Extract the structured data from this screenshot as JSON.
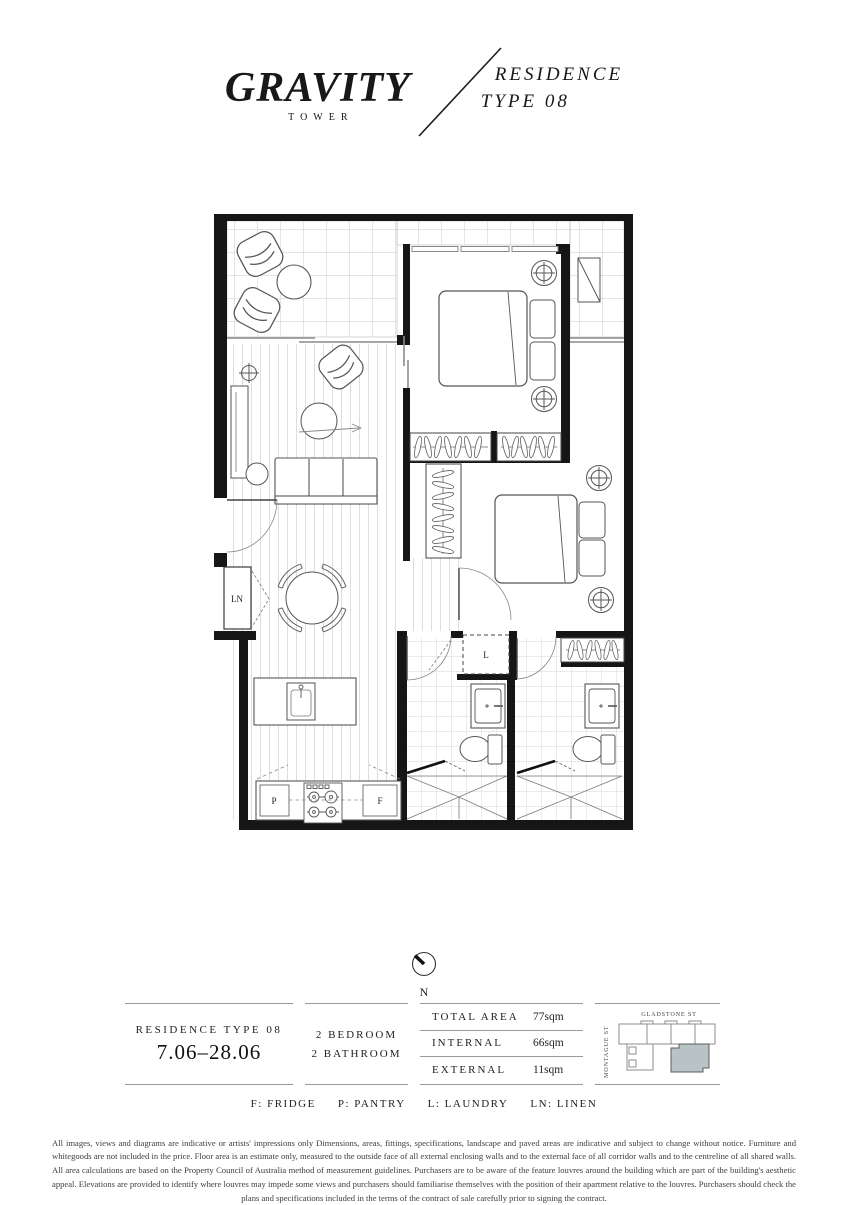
{
  "header": {
    "brand": "GRAVITY",
    "brand_sub": "TOWER",
    "residence_line1": "RESIDENCE",
    "residence_line2": "TYPE 08"
  },
  "plan": {
    "labels": {
      "linen": "LN",
      "laundry": "L",
      "pantry": "P",
      "fridge": "F"
    }
  },
  "compass": {
    "north_label": "N"
  },
  "info": {
    "residence_title": "RESIDENCE TYPE 08",
    "residence_levels": "7.06–28.06",
    "config_line1": "2 BEDROOM",
    "config_line2": "2 BATHROOM",
    "areas": {
      "rows": [
        {
          "label": "TOTAL AREA",
          "value": "77sqm"
        },
        {
          "label": "INTERNAL",
          "value": "66sqm"
        },
        {
          "label": "EXTERNAL",
          "value": "11sqm"
        }
      ]
    },
    "keyplan": {
      "street_top": "GLADSTONE ST",
      "street_left": "MONTAGUE ST",
      "highlight_color": "#b7c3c4"
    }
  },
  "legend": {
    "items": [
      "F: FRIDGE",
      "P: PANTRY",
      "L: LAUNDRY",
      "LN: LINEN"
    ]
  },
  "disclaimer": "All images, views and diagrams are indicative or artists' impressions only Dimensions, areas, fittings, specifications, landscape and paved areas are indicative and subject to change without notice. Furniture and whitegoods are not included in the price. Floor area is an estimate only, measured to the outside face of all external enclosing walls and to the external face of all corridor walls and to the centreline of all shared walls. All area calculations are based on the Property Council of Australia method of measurement guidelines. Purchasers are to be aware of the feature louvres around the building which are part of the building's aesthetic appeal. Elevations are provided to identify where louvres may impede some views and purchasers should familiarise themselves with the position of their apartment relative to the louvres. Purchasers should check the plans and specifications included in the terms of the contract of sale carefully prior to signing the contract."
}
